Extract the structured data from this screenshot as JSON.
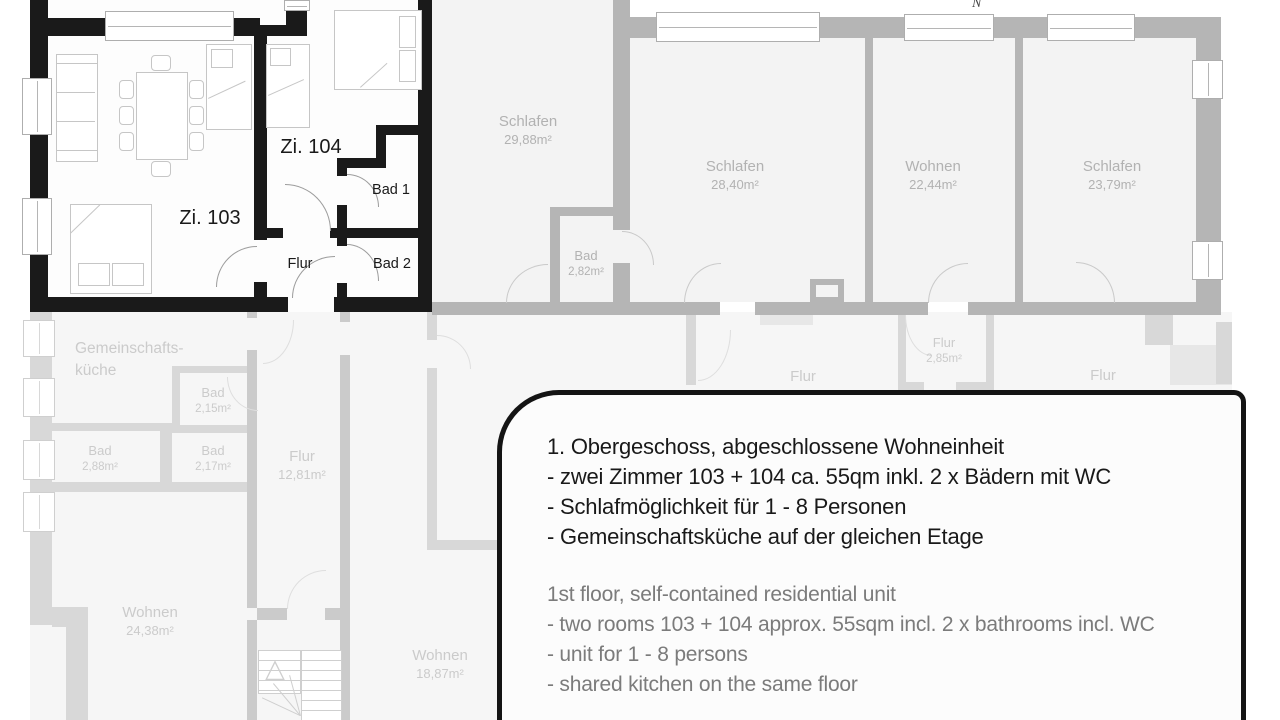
{
  "north_indicator": "N",
  "unit": {
    "zi103": "Zi. 103",
    "zi104": "Zi. 104",
    "bad1": "Bad 1",
    "bad2": "Bad 2",
    "flur": "Flur"
  },
  "upper_rooms": {
    "schlafen1": {
      "name": "Schlafen",
      "area": "29,88m²"
    },
    "schlafen2": {
      "name": "Schlafen",
      "area": "28,40m²"
    },
    "wohnen": {
      "name": "Wohnen",
      "area": "22,44m²"
    },
    "schlafen3": {
      "name": "Schlafen",
      "area": "23,79m²"
    },
    "bad": {
      "name": "Bad",
      "area": "2,82m²"
    }
  },
  "lower_rooms": {
    "kitchen_line1": "Gemeinschafts-",
    "kitchen_line2": "küche",
    "bad215": {
      "name": "Bad",
      "area": "2,15m²"
    },
    "bad288": {
      "name": "Bad",
      "area": "2,88m²"
    },
    "bad217": {
      "name": "Bad",
      "area": "2,17m²"
    },
    "flur_main": {
      "name": "Flur",
      "area": "12,81m²"
    },
    "flur_small": {
      "name": "Flur",
      "area": "2,85m²"
    },
    "flur_left": "Flur",
    "flur_right": "Flur",
    "wohnen2438": {
      "name": "Wohnen",
      "area": "24,38m²"
    },
    "wohnen1887": {
      "name": "Wohnen",
      "area": "18,87m²"
    }
  },
  "callout": {
    "german": [
      "1. Obergeschoss, abgeschlossene Wohneinheit",
      "- zwei Zimmer 103 + 104 ca. 55qm inkl. 2 x Bädern mit WC",
      "- Schlafmöglichkeit für 1 - 8 Personen",
      "- Gemeinschaftsküche auf der gleichen Etage"
    ],
    "english": [
      "1st floor, self-contained residential unit",
      "- two rooms 103 + 104 approx. 55sqm incl. 2 x bathrooms incl. WC",
      "- unit for 1 - 8 persons",
      "- shared kitchen on the same floor"
    ]
  },
  "colors": {
    "unit_wall": "#1a1a1a",
    "upper_wall": "#b5b5b5",
    "lower_wall": "#d8d8d8",
    "upper_text": "#b2b2b2",
    "lower_text": "#cbcbcb",
    "callout_border": "#141414",
    "english_text": "#7b7b7b"
  }
}
